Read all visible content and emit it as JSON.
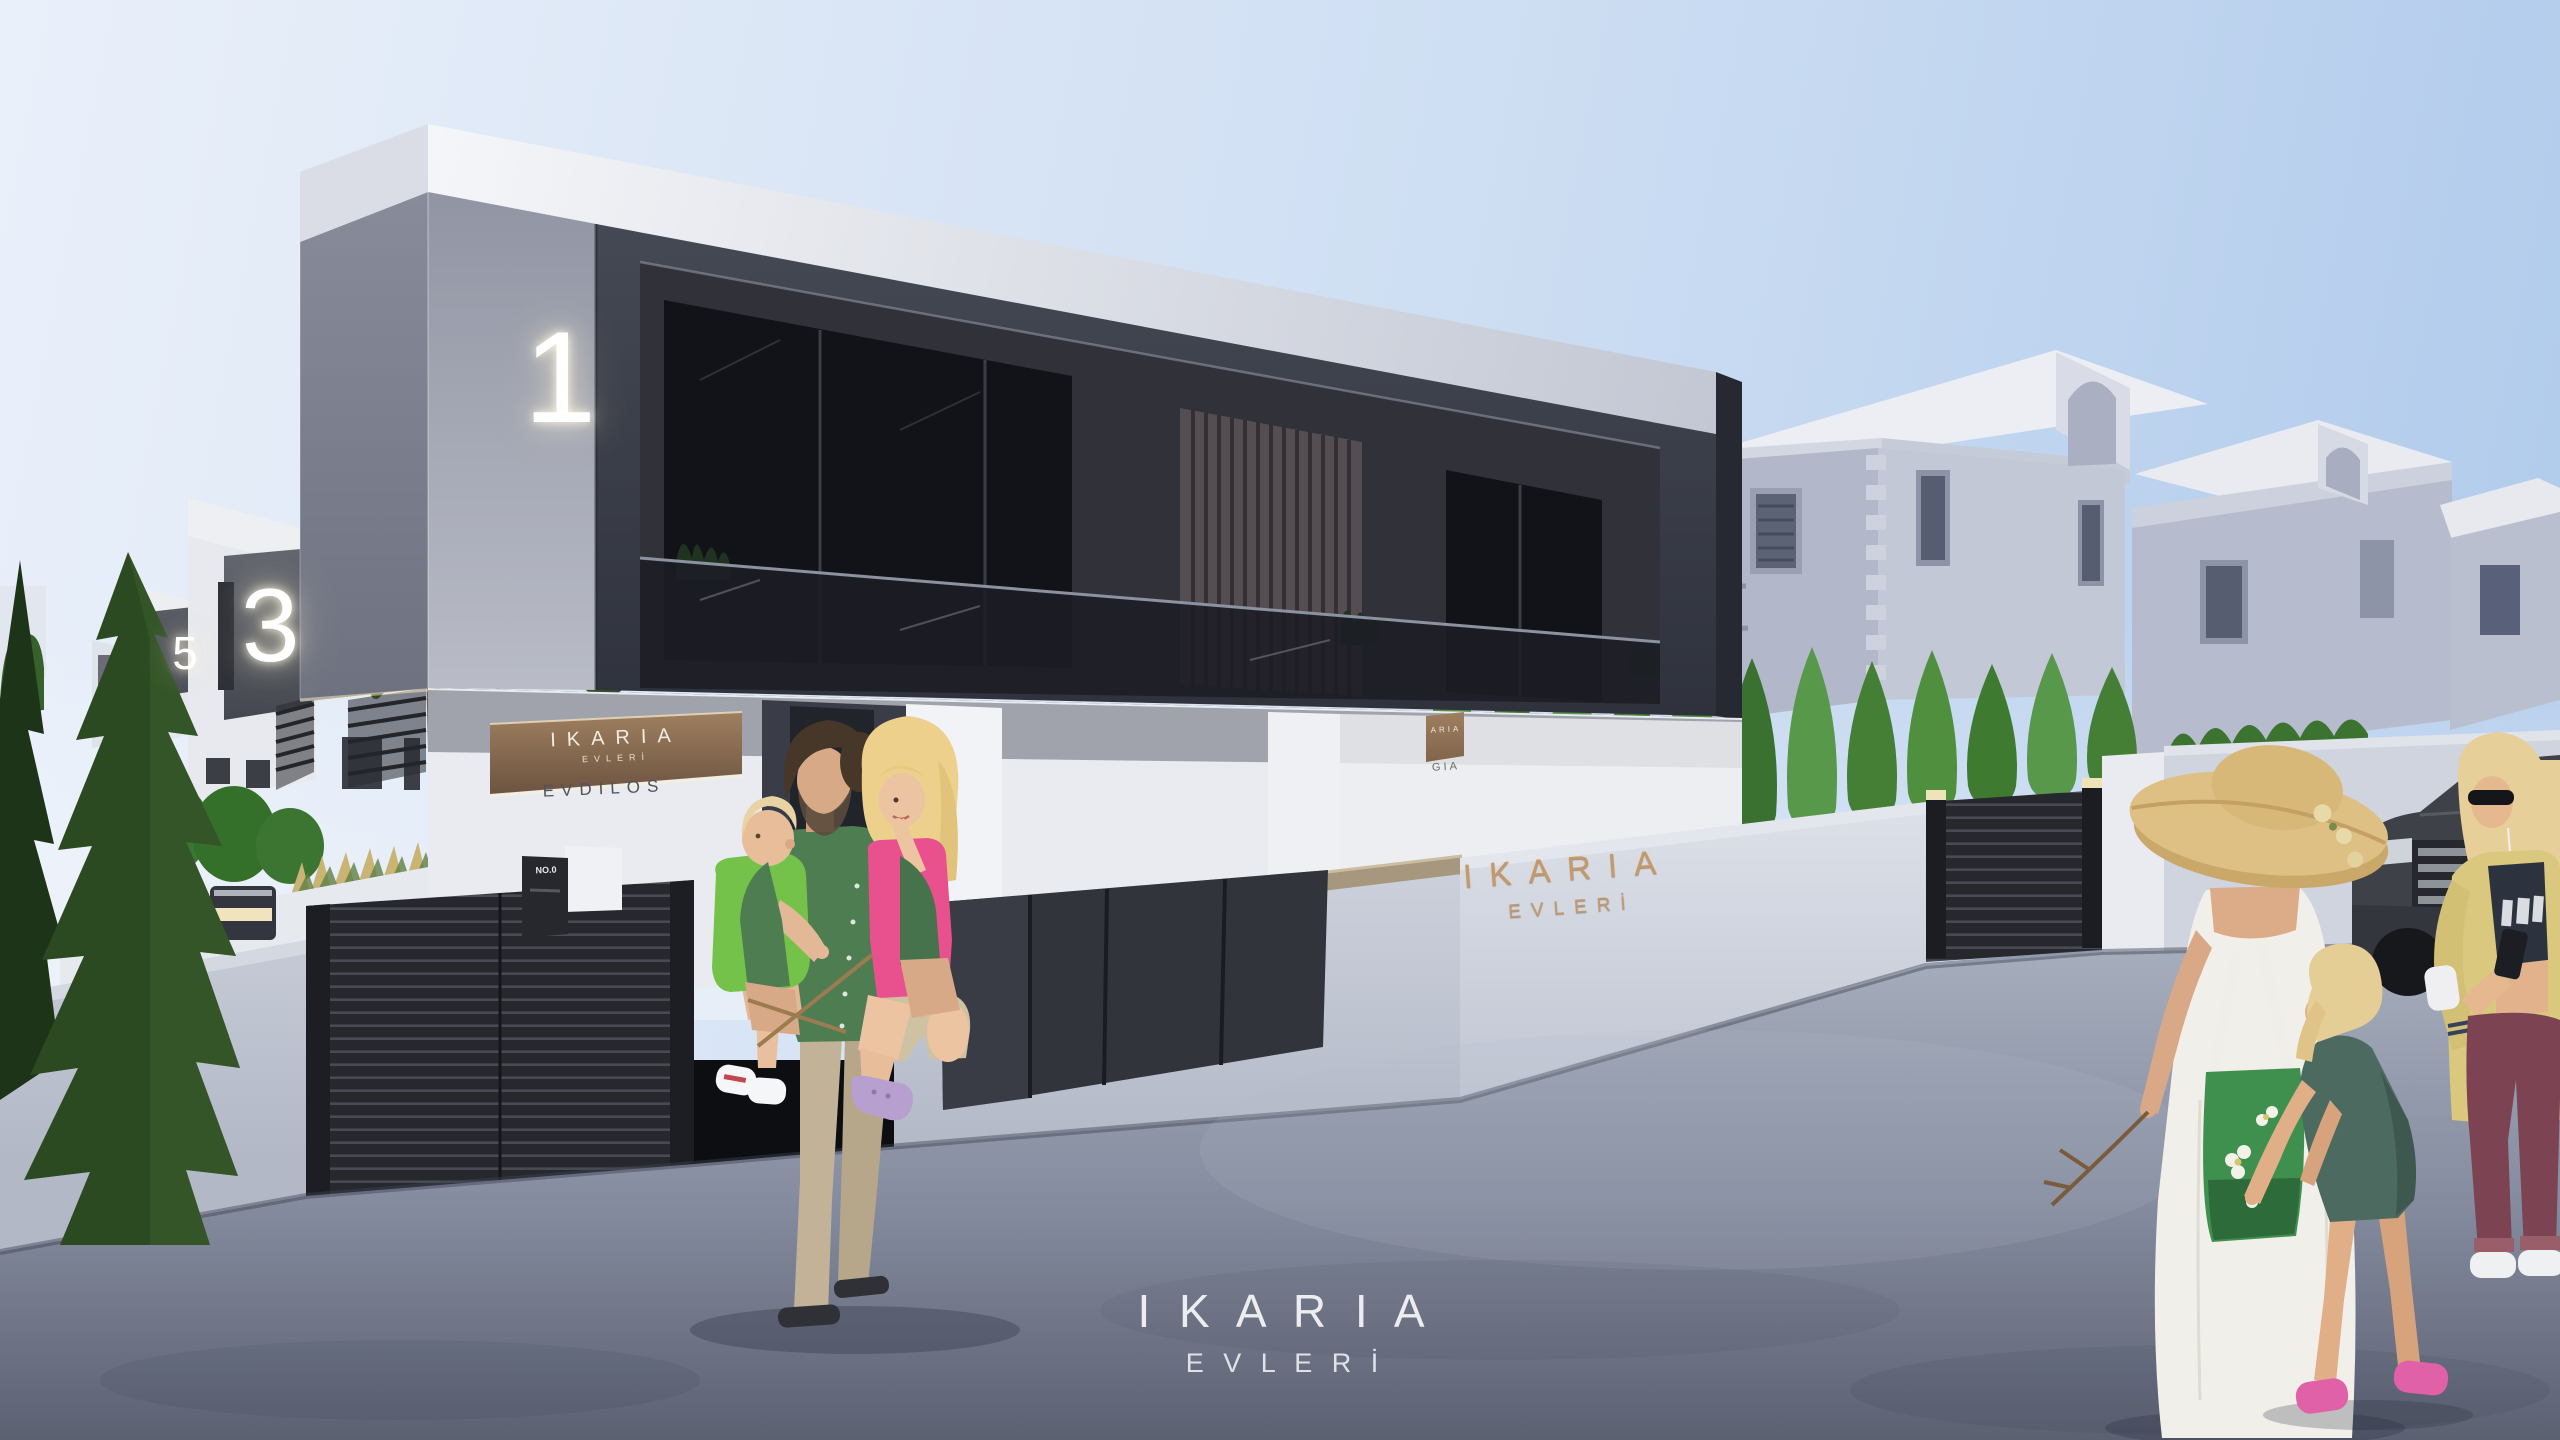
{
  "meta": {
    "title": "IKARIA EVLERİ — architectural exterior rendering",
    "scene": "Street view of modern duplex villas with family and passersby"
  },
  "branding": {
    "watermark_line1": "I K A R I A",
    "watermark_line2": "E V L E R İ",
    "wall_sign_line1": "IKARIA",
    "wall_sign_line2": "EVLERİ",
    "plaque_brand_line1": "IKARIA",
    "plaque_brand_line2": "EVLERİ",
    "plaque_villa_name": "EVDILOS",
    "neighbor_plaque_brand_partial": "ARIA",
    "neighbor_plaque_name_partial": "GIA",
    "mailbox_label": "NO.0"
  },
  "house_numbers": {
    "front_villa": "1",
    "left_villa_near": "3",
    "left_villa_far": "5"
  },
  "colors": {
    "sky_left": "#eaf0fa",
    "sky_right": "#b2ccec",
    "facade_dark": "#3b3e48",
    "facade_side_gray": "#979baa",
    "roof_band": "#eef0f5",
    "white_wall": "#e9ebf0",
    "boundary_wall": "#c6cbd7",
    "gate_dark": "#26282e",
    "utility_panel": "#32343c",
    "wood_plaque": "#8a6f52",
    "gold_lettering": "#c49a6c",
    "hedge_green": "#4a8a3a",
    "conifer_green": "#2c4a22",
    "road_near": "#5c6172",
    "road_far": "#a6adbc",
    "glass_dark": "#15161c"
  }
}
